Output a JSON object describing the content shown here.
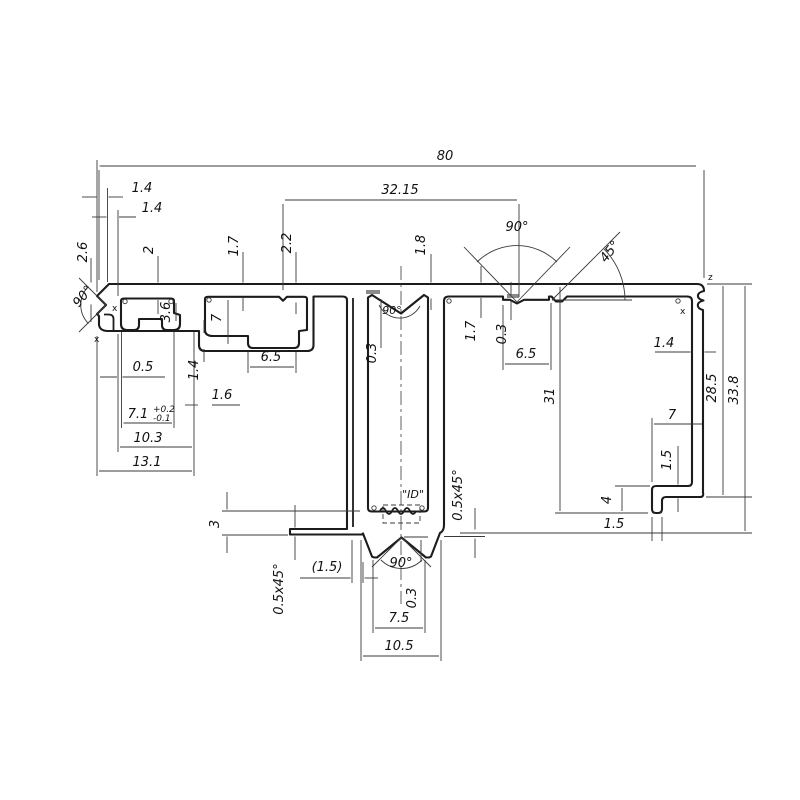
{
  "dims": {
    "d80": "80",
    "d3215": "32.15",
    "d14a": "1.4",
    "d14b": "1.4",
    "d26": "2.6",
    "a90l": "90°",
    "d2": "2",
    "d17a": "1.7",
    "d22": "2.2",
    "d18": "1.8",
    "a90t": "90°",
    "a45": "45°",
    "a90s": "90°",
    "d03s": "0.3",
    "d36": "3.6",
    "d7a": "7",
    "d05": "0.5",
    "d71": "7.1",
    "d71tp": "+0.2",
    "d71tm": "-0.1",
    "d103": "10.3",
    "d131": "13.1",
    "d14c": "1.4",
    "d16": "1.6",
    "d65a": "6.5",
    "d17b": "1.7",
    "d03b": "0.3",
    "d65b": "6.5",
    "d31": "31",
    "d14d": "1.4",
    "d285": "28.5",
    "d338": "33.8",
    "d7b": "7",
    "d15a": "1.5",
    "d4": "4",
    "d15b": "1.5",
    "d3": "3",
    "ch1": "0.5x45°",
    "d15p": "(1.5)",
    "a90b": "90°",
    "d03c": "0.3",
    "d75": "7.5",
    "d105": "10.5",
    "ch2": "0.5x45°"
  },
  "labels": {
    "id": "\"ID\"",
    "z": "z",
    "x": "x",
    "xmark": "x",
    "corner_marker": "o"
  }
}
